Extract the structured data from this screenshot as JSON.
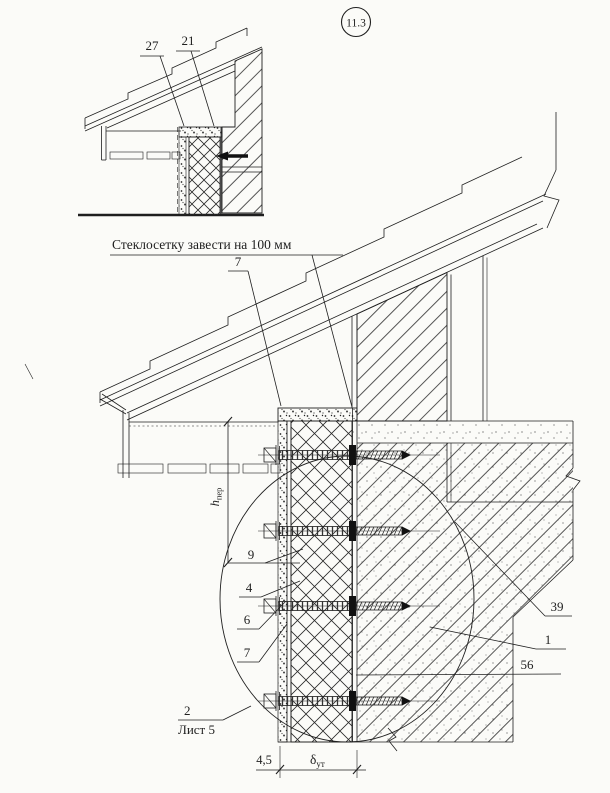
{
  "drawing": {
    "node_number": "11.3",
    "note": "Стеклосетку завести на 100 мм",
    "ref_note": {
      "number": "2",
      "sheet": "Лист 5"
    },
    "callouts": {
      "c27": "27",
      "c21": "21",
      "c7top": "7",
      "c9": "9",
      "c4": "4",
      "c6": "6",
      "c7b": "7",
      "c39": "39",
      "c1": "1",
      "c56": "56"
    },
    "dims": {
      "h_base": "h",
      "h_sub": "пер",
      "delta_base": "δ",
      "delta_sub": "ут",
      "plaster": "4,5"
    },
    "colors": {
      "ink": "#1f1f1f",
      "paper": "#fbfbf8"
    }
  }
}
